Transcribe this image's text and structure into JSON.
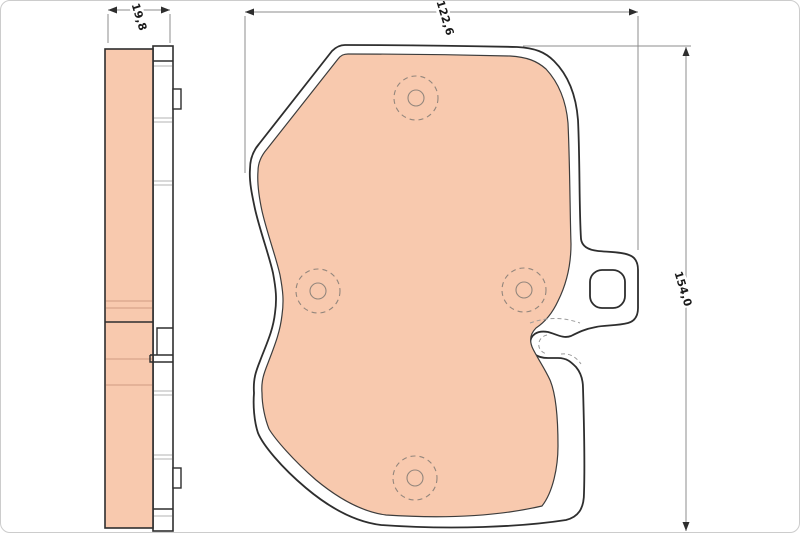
{
  "dimensions": {
    "thickness": "19,8",
    "width": "122,6",
    "height": "154,0"
  },
  "colors": {
    "pad-fill": "#f8c9ae",
    "pad-line": "#cf9c82",
    "outline": "#2e2e2e",
    "inner-stroke": "#3c3c3c",
    "dim-line": "#8c8c8c",
    "marker": "#93867c",
    "plate-line": "#b3b3b3",
    "hidden-line": "#9a9a9a",
    "label-ink": "#1a1a1a",
    "frame": "#cccccc"
  }
}
